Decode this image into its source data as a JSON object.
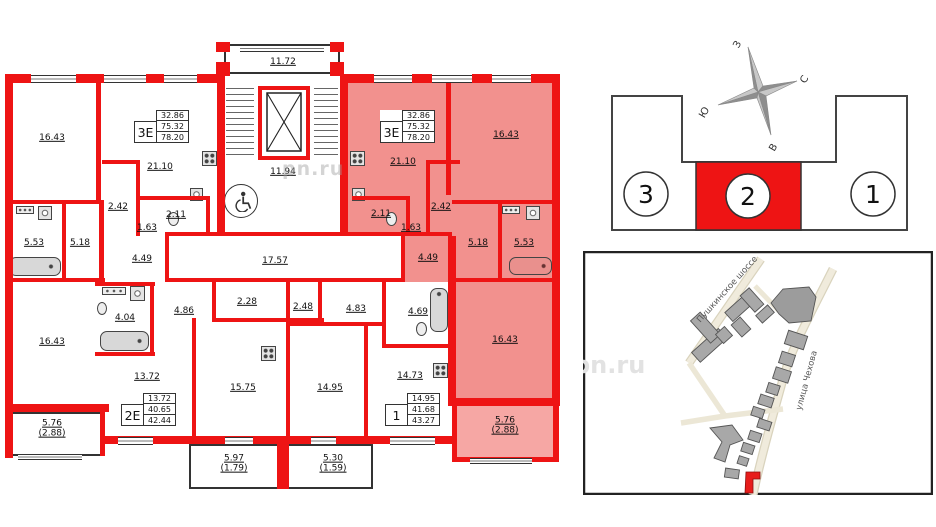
{
  "watermark": {
    "text": "pn.ru"
  },
  "plan": {
    "stair": {
      "upper_landing": "11.72",
      "lower_landing": "11.94"
    },
    "corridor": {
      "label": "17.57"
    },
    "apartments": [
      {
        "badge": "3Е",
        "rows": [
          "32.86",
          "75.32",
          "78.20"
        ]
      },
      {
        "badge": "3Е",
        "rows": [
          "32.86",
          "75.32",
          "78.20"
        ]
      },
      {
        "badge": "2Е",
        "rows": [
          "13.72",
          "40.65",
          "42.44"
        ]
      },
      {
        "badge": "1",
        "rows": [
          "14.95",
          "41.68",
          "43.27"
        ]
      }
    ],
    "rooms": [
      {
        "label": "16.43"
      },
      {
        "label": "21.10"
      },
      {
        "label": "2.42"
      },
      {
        "label": "2.11"
      },
      {
        "label": "1.63"
      },
      {
        "label": "5.53"
      },
      {
        "label": "5.18"
      },
      {
        "label": "4.49"
      },
      {
        "label": "16.43"
      },
      {
        "label": "5.76",
        "sub": "(2.88)"
      },
      {
        "label": "4.04"
      },
      {
        "label": "4.86"
      },
      {
        "label": "2.28"
      },
      {
        "label": "13.72"
      },
      {
        "label": "15.75"
      },
      {
        "label": "5.97",
        "sub": "(1.79)"
      },
      {
        "label": "2.48"
      },
      {
        "label": "4.83"
      },
      {
        "label": "4.69"
      },
      {
        "label": "14.95"
      },
      {
        "label": "14.73"
      },
      {
        "label": "5.30",
        "sub": "(1.59)"
      },
      {
        "label": "21.10"
      },
      {
        "label": "16.43"
      },
      {
        "label": "2.11"
      },
      {
        "label": "2.42"
      },
      {
        "label": "1.63"
      },
      {
        "label": "5.18"
      },
      {
        "label": "5.53"
      },
      {
        "label": "4.49"
      },
      {
        "label": "16.43"
      },
      {
        "label": "5.76",
        "sub": "(2.88)"
      }
    ]
  },
  "section_diagram": {
    "sections": [
      {
        "number": "3"
      },
      {
        "number": "2"
      },
      {
        "number": "1"
      }
    ],
    "active_section": "2",
    "accent_color": "#ee1414",
    "compass": {
      "west": "З",
      "north": "С",
      "south": "Ю",
      "east": "В"
    }
  },
  "map": {
    "streets": [
      {
        "name": "Пушкинское шоссе"
      },
      {
        "name": "улица Чехова"
      }
    ]
  }
}
